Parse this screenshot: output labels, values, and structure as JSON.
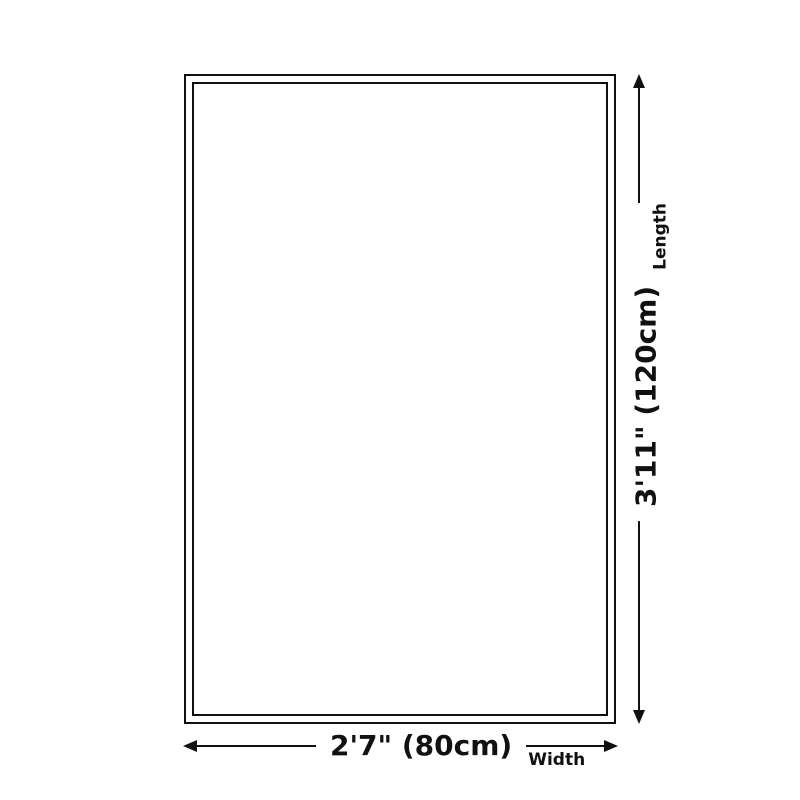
{
  "diagram": {
    "title": "product-size-diagram",
    "length": {
      "value": "3'11\" (120cm)",
      "label": "Length"
    },
    "width": {
      "value": "2'7\" (80cm)",
      "label": "Width"
    },
    "colors": {
      "line": "#111111",
      "background": "#ffffff"
    },
    "icons": [
      "arrow-up-icon",
      "arrow-down-icon",
      "arrow-left-icon",
      "arrow-right-icon"
    ]
  }
}
